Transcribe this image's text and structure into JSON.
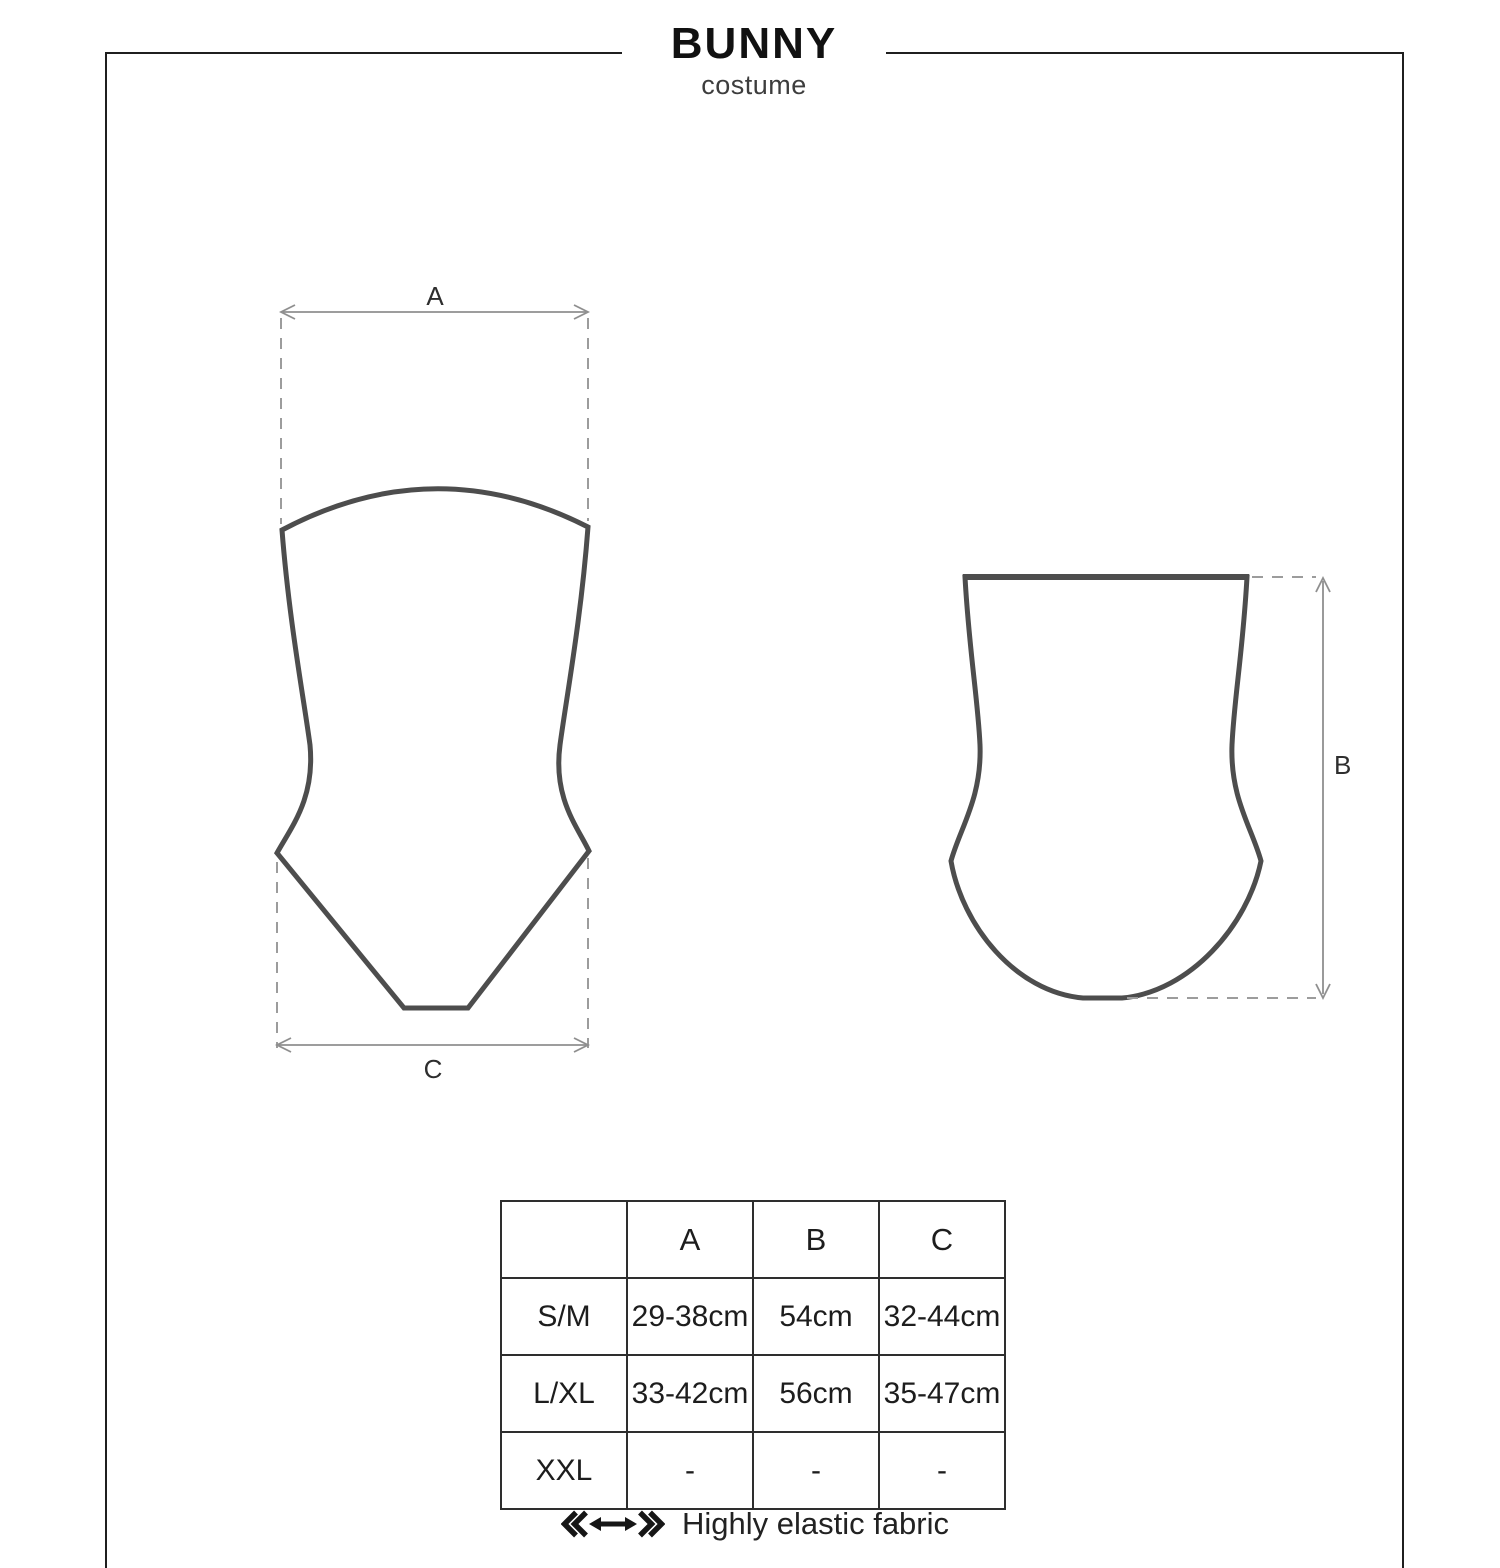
{
  "header": {
    "product_name": "BUNNY",
    "product_type": "costume"
  },
  "diagram": {
    "front_view": "strapless-bodysuit-front-outline",
    "back_view": "high-waist-bottom-back-outline",
    "dim_a": {
      "label": "A"
    },
    "dim_b": {
      "label": "B"
    },
    "dim_c": {
      "label": "C"
    }
  },
  "size_table": {
    "col_headers": [
      "A",
      "B",
      "C"
    ],
    "rows": [
      {
        "size": "S/M",
        "a": "29-38cm",
        "b": "54cm",
        "c": "32-44cm"
      },
      {
        "size": "L/XL",
        "a": "33-42cm",
        "b": "56cm",
        "c": "35-47cm"
      },
      {
        "size": "XXL",
        "a": "-",
        "b": "-",
        "c": "-"
      }
    ]
  },
  "legend": {
    "icon": "stretch-arrow-icon",
    "label": "Highly elastic fabric"
  },
  "colors": {
    "outline": "#4d4d4d",
    "dimension_gray": "#8f8f8f",
    "dash_gray": "#9c9c9c",
    "frame_border": "#1f1f1f",
    "table_border": "#2e2e2e",
    "text_dark": "#1d1d1d",
    "background": "#ffffff"
  }
}
